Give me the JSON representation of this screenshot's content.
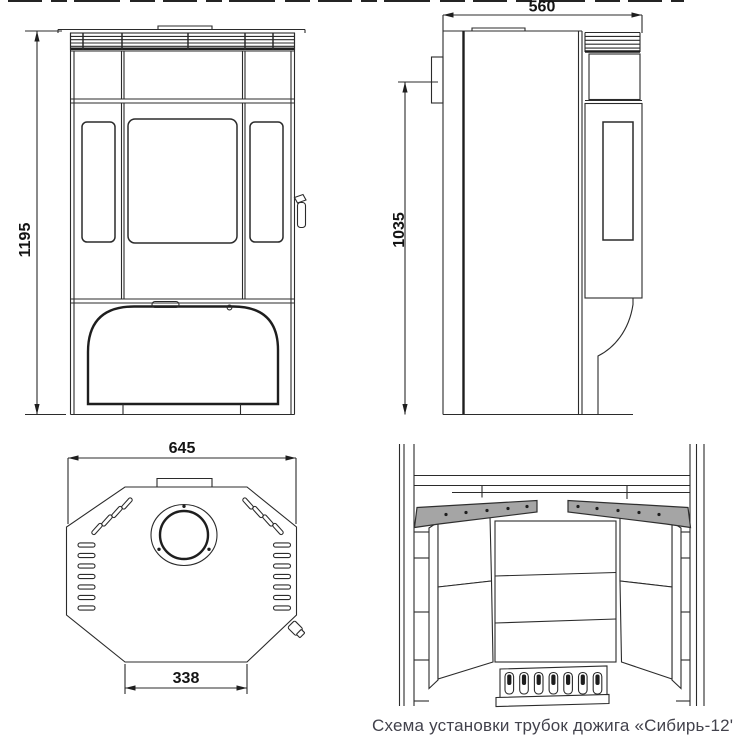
{
  "caption": {
    "text": "Схема установки трубок дожига «Сибирь-12'"
  },
  "dimensions": {
    "front_height_mm": "1195",
    "side_depth_mm": "560",
    "side_height_mm": "1035",
    "top_width_mm": "645",
    "top_base_width_mm": "338"
  },
  "colors": {
    "line": "#2b2b2b",
    "tube_fill": "#a5a5a5",
    "background": "#ffffff",
    "caption_text": "#42424c"
  }
}
